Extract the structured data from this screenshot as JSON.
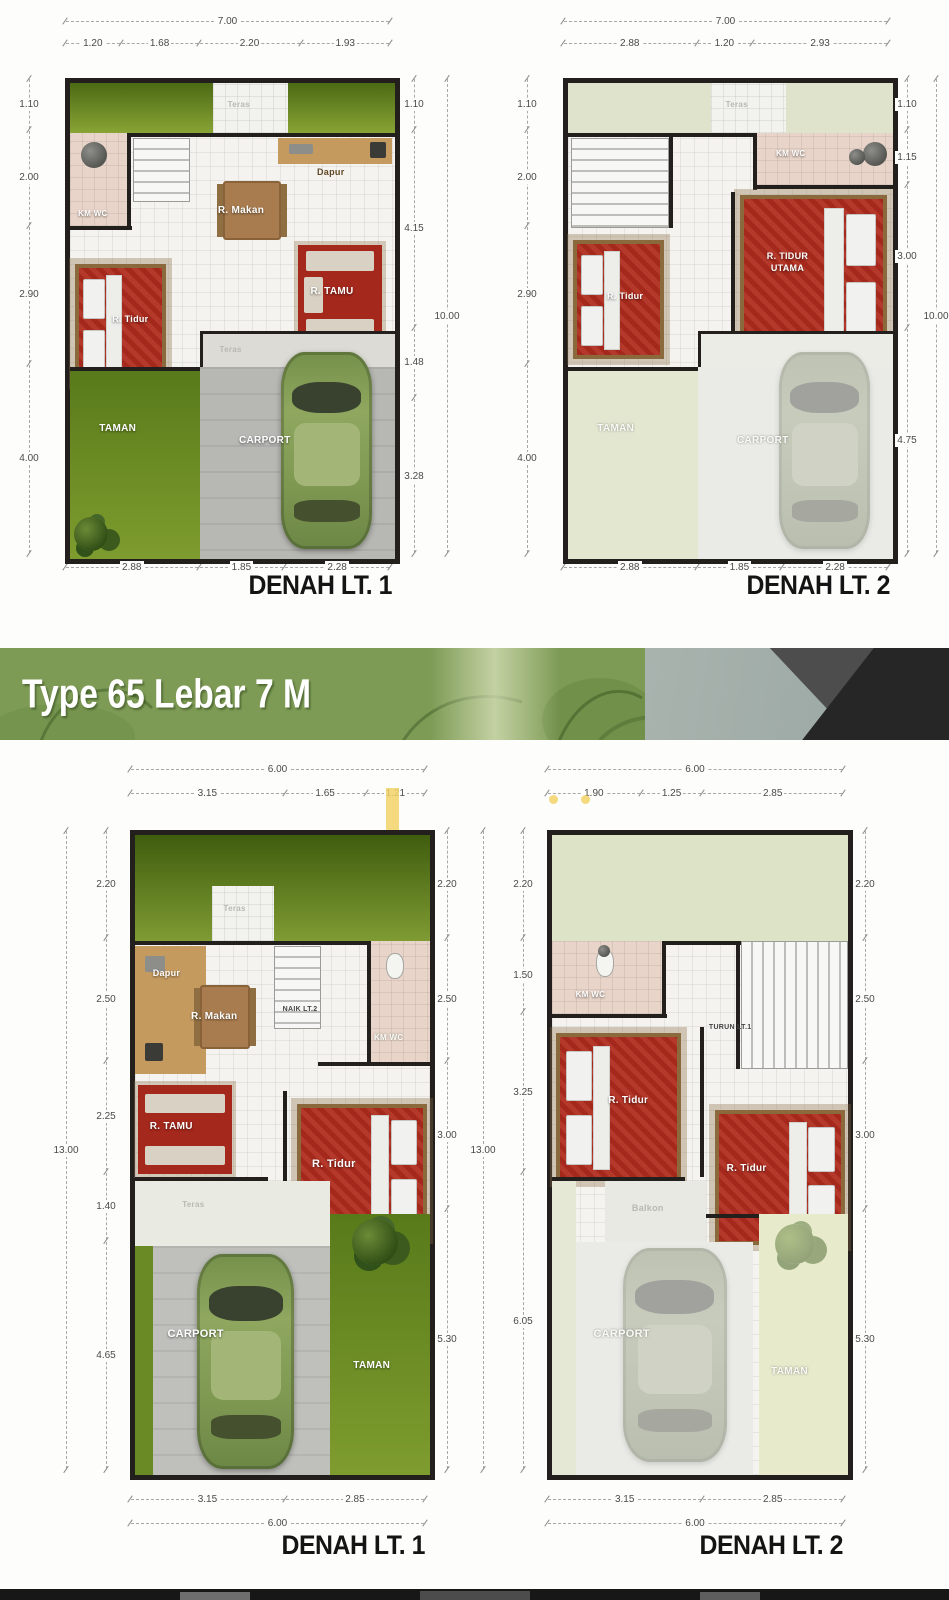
{
  "palette": {
    "wall": "#231f1c",
    "accent-red": "#a5281c",
    "banner-green": "#7d9b55",
    "wc-pink": "#e8d4c8",
    "wood-tan": "#c49a5f",
    "dim-text": "#4a4a4a"
  },
  "banner": {
    "title": "Type 65 Lebar 7 M"
  },
  "plans": [
    {
      "title": "DENAH  LT. 1",
      "dims": {
        "top_total": "7.00",
        "top": [
          "1.20",
          "1.68",
          "2.20",
          "1.93"
        ],
        "left": [
          "1.10",
          "2.00",
          "2.90",
          "4.00"
        ],
        "right": [
          "1.10",
          "4.15",
          "1.48",
          "3.28"
        ],
        "right_total": "10.00",
        "bottom": [
          "2.88",
          "1.85",
          "2.28"
        ]
      },
      "rooms": {
        "teras_top": "Teras",
        "km_wc": "KM WC",
        "dapur": "Dapur",
        "r_makan": "R. Makan",
        "r_tamu": "R. TAMU",
        "r_tidur": "R. Tidur",
        "teras_mid": "Teras",
        "taman": "TAMAN",
        "carport": "CARPORT"
      }
    },
    {
      "title": "DENAH  LT. 2",
      "dims": {
        "top_total": "7.00",
        "top": [
          "2.88",
          "1.20",
          "2.93"
        ],
        "left": [
          "1.10",
          "2.00",
          "2.90",
          "4.00"
        ],
        "right": [
          "1.10",
          "1.15",
          "3.00",
          "4.75"
        ],
        "right_total": "10.00",
        "bottom": [
          "2.88",
          "1.85",
          "2.28"
        ]
      },
      "rooms": {
        "teras_top": "Teras",
        "km_wc": "KM WC",
        "r_tidur": "R. Tidur",
        "r_tidur_utama": "R. TIDUR UTAMA",
        "taman": "TAMAN",
        "carport": "CARPORT"
      }
    },
    {
      "title": "DENAH  LT. 1",
      "dims": {
        "top_total": "6.00",
        "top": [
          "3.15",
          "1.65",
          "1.21"
        ],
        "left_total": "13.00",
        "left": [
          "2.20",
          "2.50",
          "2.25",
          "1.40",
          "4.65"
        ],
        "right": [
          "2.20",
          "2.50",
          "3.00",
          "5.30"
        ],
        "bottom": [
          "3.15",
          "2.85"
        ],
        "bottom_total": "6.00"
      },
      "rooms": {
        "teras_top": "Teras",
        "dapur": "Dapur",
        "r_makan": "R. Makan",
        "naik": "NAIK LT.2",
        "km_wc": "KM WC",
        "r_tamu": "R. TAMU",
        "r_tidur": "R. Tidur",
        "teras_mid": "Teras",
        "carport": "CARPORT",
        "taman": "TAMAN"
      }
    },
    {
      "title": "DENAH  LT. 2",
      "dims": {
        "top_total": "6.00",
        "top": [
          "1.90",
          "1.25",
          "2.85"
        ],
        "left_total": "13.00",
        "left": [
          "2.20",
          "1.50",
          "3.25",
          "6.05"
        ],
        "right": [
          "2.20",
          "2.50",
          "3.00",
          "5.30"
        ],
        "bottom": [
          "3.15",
          "2.85"
        ],
        "bottom_total": "6.00"
      },
      "rooms": {
        "km_wc": "KM WC",
        "turun": "TURUN LT.1",
        "r_tidur_1": "R. Tidur",
        "r_tidur_2": "R. Tidur",
        "balkon": "Balkon",
        "carport": "CARPORT",
        "taman": "TAMAN"
      }
    }
  ]
}
